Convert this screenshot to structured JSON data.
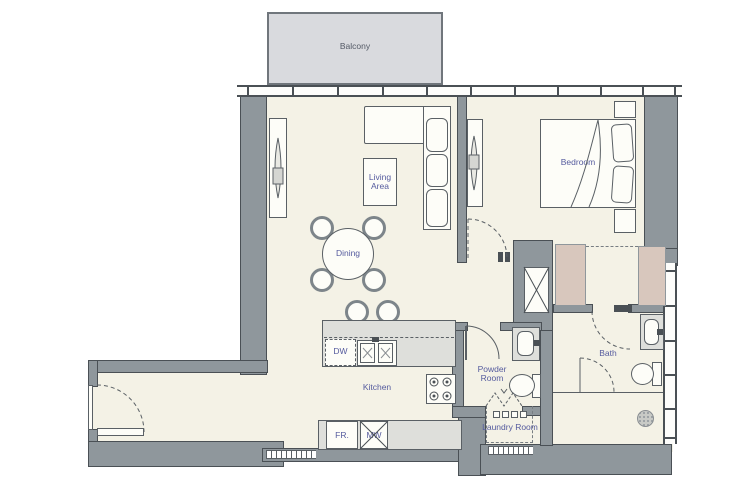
{
  "plan": {
    "title": "Apartment floor plan"
  },
  "colors": {
    "floor": "#f4f2e6",
    "balcony_fill": "#d9dade",
    "wall": "#8f979c",
    "wall_outline": "#4a5055",
    "closet_fill": "#d8c7bd",
    "counter_fill": "#dedfdb",
    "room_label": "#555b9e",
    "balcony_label": "#545a66"
  },
  "rooms": {
    "balcony": {
      "label": "Balcony"
    },
    "living": {
      "label": "Living Area"
    },
    "dining": {
      "label": "Dining"
    },
    "bedroom": {
      "label": "Bedroom"
    },
    "kitchen": {
      "label": "Kitchen"
    },
    "powder": {
      "label": "Powder Room"
    },
    "bath": {
      "label": "Bath"
    },
    "laundry": {
      "label": "Laundry Room"
    }
  },
  "appliances": {
    "dishwasher": "DW",
    "fridge": "FR.",
    "microwave": "MW"
  }
}
